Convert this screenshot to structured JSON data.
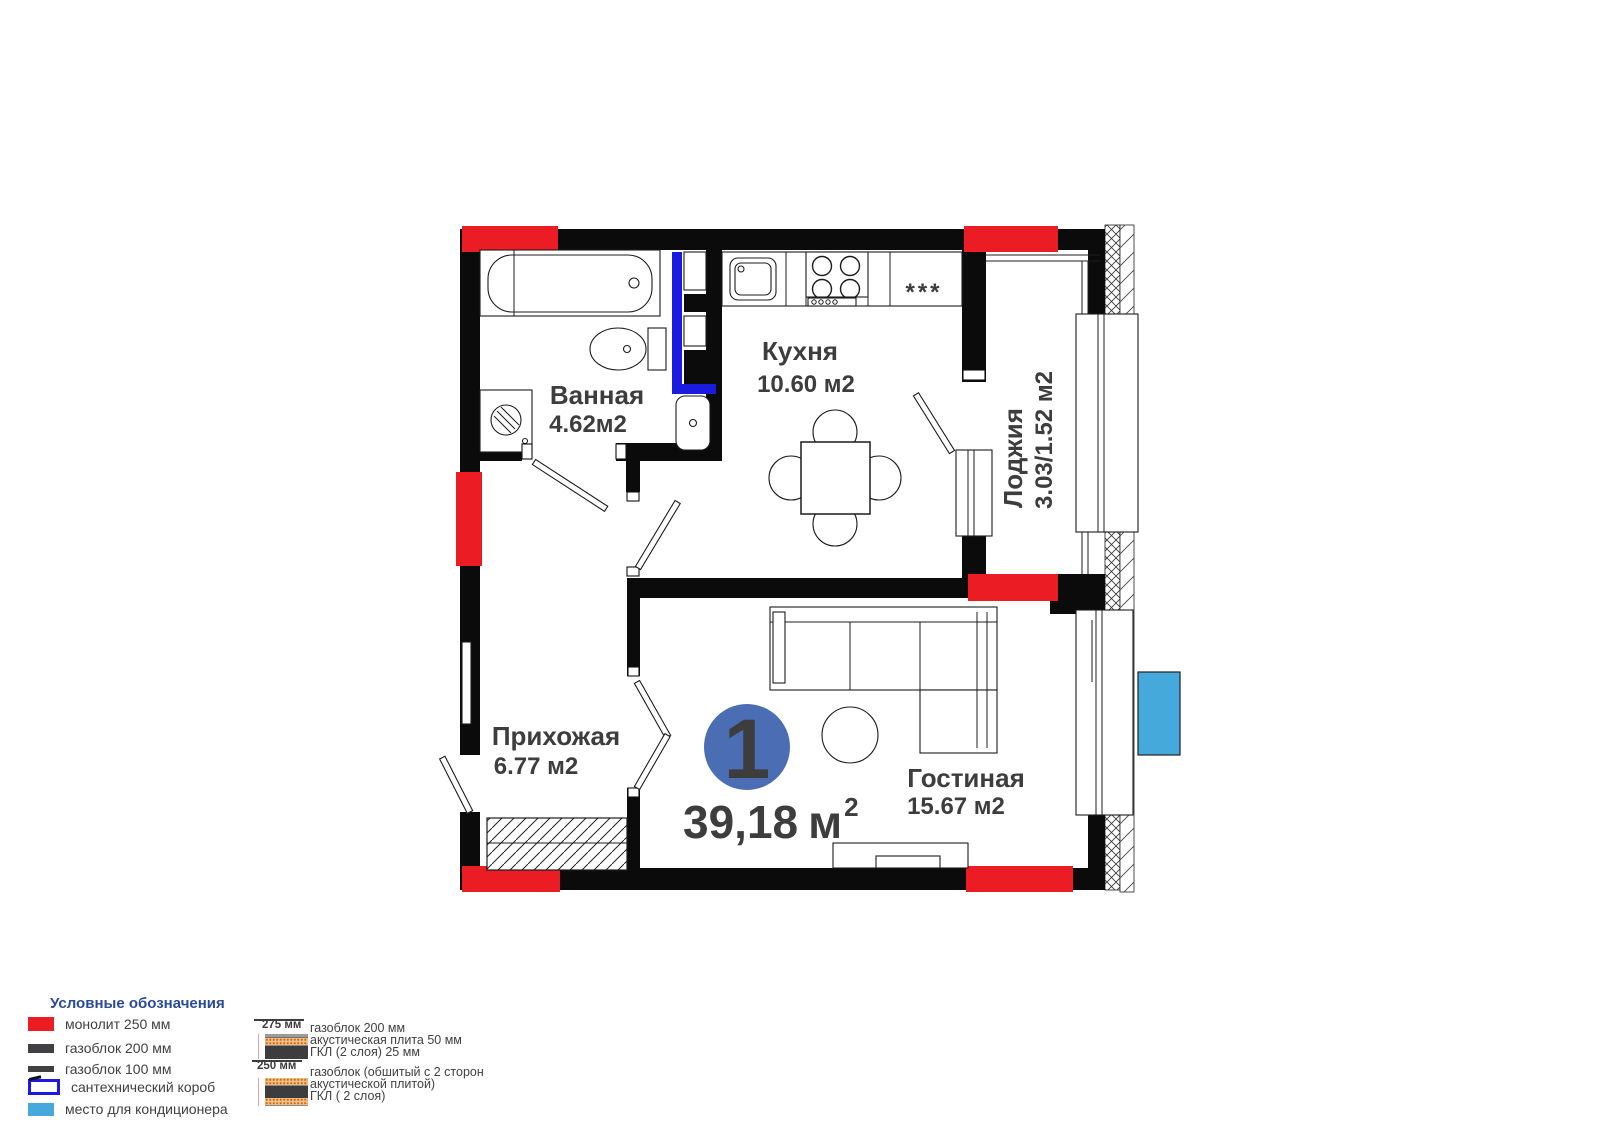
{
  "plan": {
    "unit_badge": {
      "number": "1"
    },
    "total_area": {
      "value": "39,18",
      "unit": "м",
      "sup": "2"
    },
    "rooms": [
      {
        "key": "bathroom",
        "name": "Ванная",
        "area": "4.62м2"
      },
      {
        "key": "kitchen",
        "name": "Кухня",
        "area": "10.60 м2"
      },
      {
        "key": "loggia",
        "name": "Лоджия",
        "area": "3.03/1.52 м2"
      },
      {
        "key": "hallway",
        "name": "Прихожая",
        "area": "6.77 м2"
      },
      {
        "key": "living_room",
        "name": "Гостиная",
        "area": "15.67 м2"
      }
    ],
    "fridge_symbol": "***"
  },
  "legend": {
    "title": "Условные обозначения",
    "items": [
      {
        "label": "монолит 250 мм"
      },
      {
        "label": "газоблок 200 мм"
      },
      {
        "label": "газоблок 100 мм"
      },
      {
        "label": "сантехнический короб"
      },
      {
        "label": "место для кондиционера"
      }
    ],
    "wall_sections": [
      {
        "size": "275 мм",
        "line1": "газоблок 200 мм",
        "line2": "акустическая плита 50 мм",
        "line3": "ГКЛ (2 слоя) 25 мм"
      },
      {
        "size": "250 мм",
        "line1": "газоблок (обшитый с 2 сторон",
        "line2": "акустической плитой)",
        "line3": "ГКЛ ( 2 слоя)"
      }
    ]
  },
  "colors": {
    "monolith_red": "#ec1c24",
    "wall_black": "#0b0b0b",
    "duct_blue": "#1b1be0",
    "ac_blue": "#45a9dc",
    "badge_blue": "#4a6db4",
    "legend_title_blue": "#2b4a9c",
    "text_dark": "#3d3d3d"
  }
}
